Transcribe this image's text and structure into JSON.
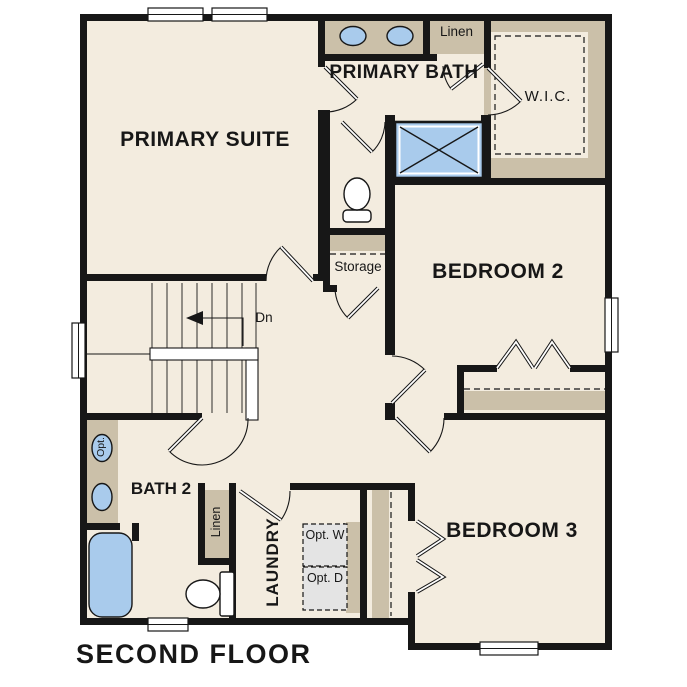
{
  "title": "SECOND FLOOR",
  "colors": {
    "wall": "#171717",
    "floor": "#f3ecdf",
    "cabinetry": "#cbc0a9",
    "plumbing_fixture": "#a9cbec",
    "optional_appliance_box": "#e4e4e4",
    "background": "#ffffff"
  },
  "rooms": {
    "primary_suite": {
      "label": "PRIMARY SUITE"
    },
    "primary_bath": {
      "label": "PRIMARY BATH"
    },
    "wic": {
      "label": "W.I.C."
    },
    "bedroom2": {
      "label": "BEDROOM 2"
    },
    "bedroom3": {
      "label": "BEDROOM 3"
    },
    "bath2": {
      "label": "BATH 2"
    },
    "laundry": {
      "label": "LAUNDRY"
    },
    "storage": {
      "label": "Storage"
    },
    "linen_upper": {
      "label": "Linen"
    },
    "linen_lower": {
      "label": "Linen"
    }
  },
  "annotations": {
    "stairs_direction": "Dn",
    "optional_washer": "Opt. W",
    "optional_dryer": "Opt. D",
    "optional_sink": "Opt."
  }
}
